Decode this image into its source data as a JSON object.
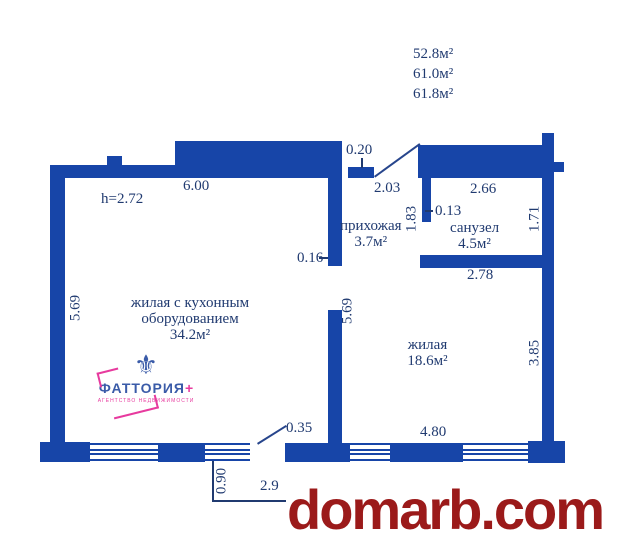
{
  "colors": {
    "wall_blue": "#1745a8",
    "label_navy": "#203a70",
    "watermark_red": "#9b1a1a",
    "logo_blue": "#3a5ba8",
    "logo_magenta": "#e73a9e"
  },
  "header_areas": [
    "52.8м²",
    "61.0м²",
    "61.8м²"
  ],
  "dims": {
    "top_width": "6.00",
    "ceiling_height": "h=2.72",
    "entry_gap": "0.20",
    "hall_width": "2.03",
    "bath_width": "2.66",
    "hall_depth": "1.83",
    "bath_wall": "0.13",
    "bath_depth": "1.71",
    "mid_wall": "0.16",
    "bath_bottom": "2.78",
    "left_height": "5.69",
    "mid_height": "5.69",
    "right_height": "3.85",
    "balcony_door": "0.35",
    "bottom_width": "4.80",
    "balcony_depth": "0.90",
    "balcony_width": "2.9"
  },
  "rooms": {
    "living_kitchen": {
      "line1": "жилая с кухонным",
      "line2": "оборудованием",
      "area": "34.2м²"
    },
    "hallway": {
      "name": "прихожая",
      "area": "3.7м²"
    },
    "bathroom": {
      "name": "санузел",
      "area": "4.5м²"
    },
    "living": {
      "name": "жилая",
      "area": "18.6м²"
    }
  },
  "logo": {
    "emblem_icon": "fleur-de-lis",
    "emblem_glyph": "⚜",
    "name": "ФАТТОРИЯ",
    "plus": "+",
    "subtitle": "АГЕНТСТВО НЕДВИЖИМОСТИ"
  },
  "watermark": "domarb.com"
}
